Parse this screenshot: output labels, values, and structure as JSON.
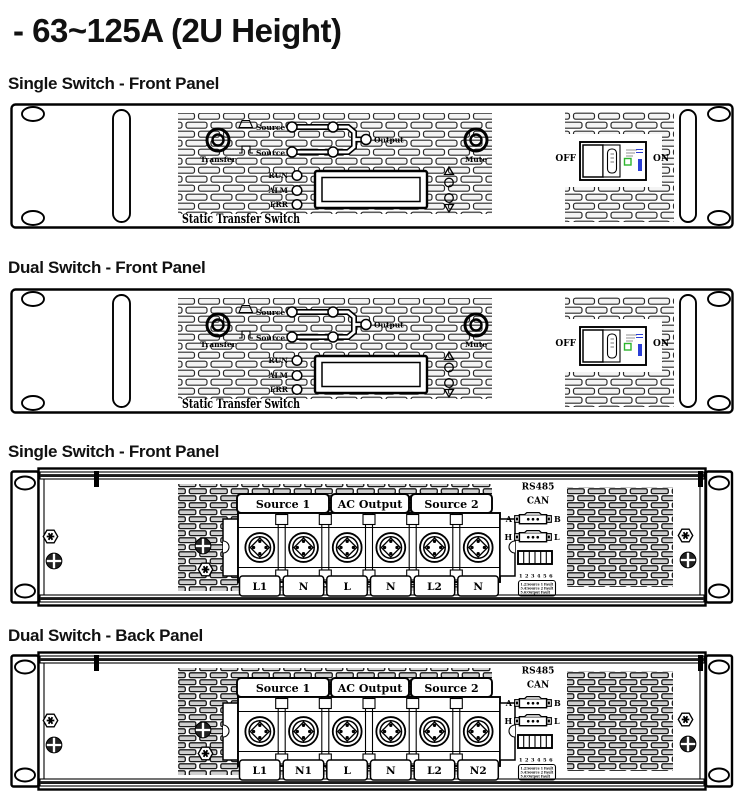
{
  "page_title": "- 63~125A (2U Height)",
  "sections": [
    {
      "title": "Single Switch - Front Panel"
    },
    {
      "title": "Dual Switch - Front Panel"
    },
    {
      "title": "Single Switch - Front Panel"
    },
    {
      "title": "Dual Switch - Back Panel"
    }
  ],
  "front_panel": {
    "transfer_label": "Transfer",
    "mute_label": "Mute",
    "source1_label": "Source 1",
    "source2_label": "Source 2",
    "output_label": "Output",
    "led_labels": [
      "RUN",
      "ALM",
      "ERR"
    ],
    "device_label": "Static Transfer Switch",
    "breaker": {
      "off_label": "OFF",
      "on_label": "ON",
      "indicator_green": "#2db52d",
      "indicator_blue": "#2b3fd6"
    }
  },
  "back_panel": {
    "group_labels": [
      "Source 1",
      "AC Output",
      "Source 2"
    ],
    "rs485_label": "RS485",
    "can_label": "CAN",
    "port1_left": "A",
    "port1_right": "B",
    "port2_left": "H",
    "port2_right": "L",
    "pin_numbers": "1 2 3 4 5 6",
    "pin_legend": [
      "1.2:Source 1 Fault",
      "3.4:Source 2 Fault",
      "5.6:Output Fault"
    ],
    "single_terminals": [
      "L1",
      "N",
      "L",
      "N",
      "L2",
      "N"
    ],
    "dual_terminals": [
      "L1",
      "N1",
      "L",
      "N",
      "L2",
      "N2"
    ]
  }
}
